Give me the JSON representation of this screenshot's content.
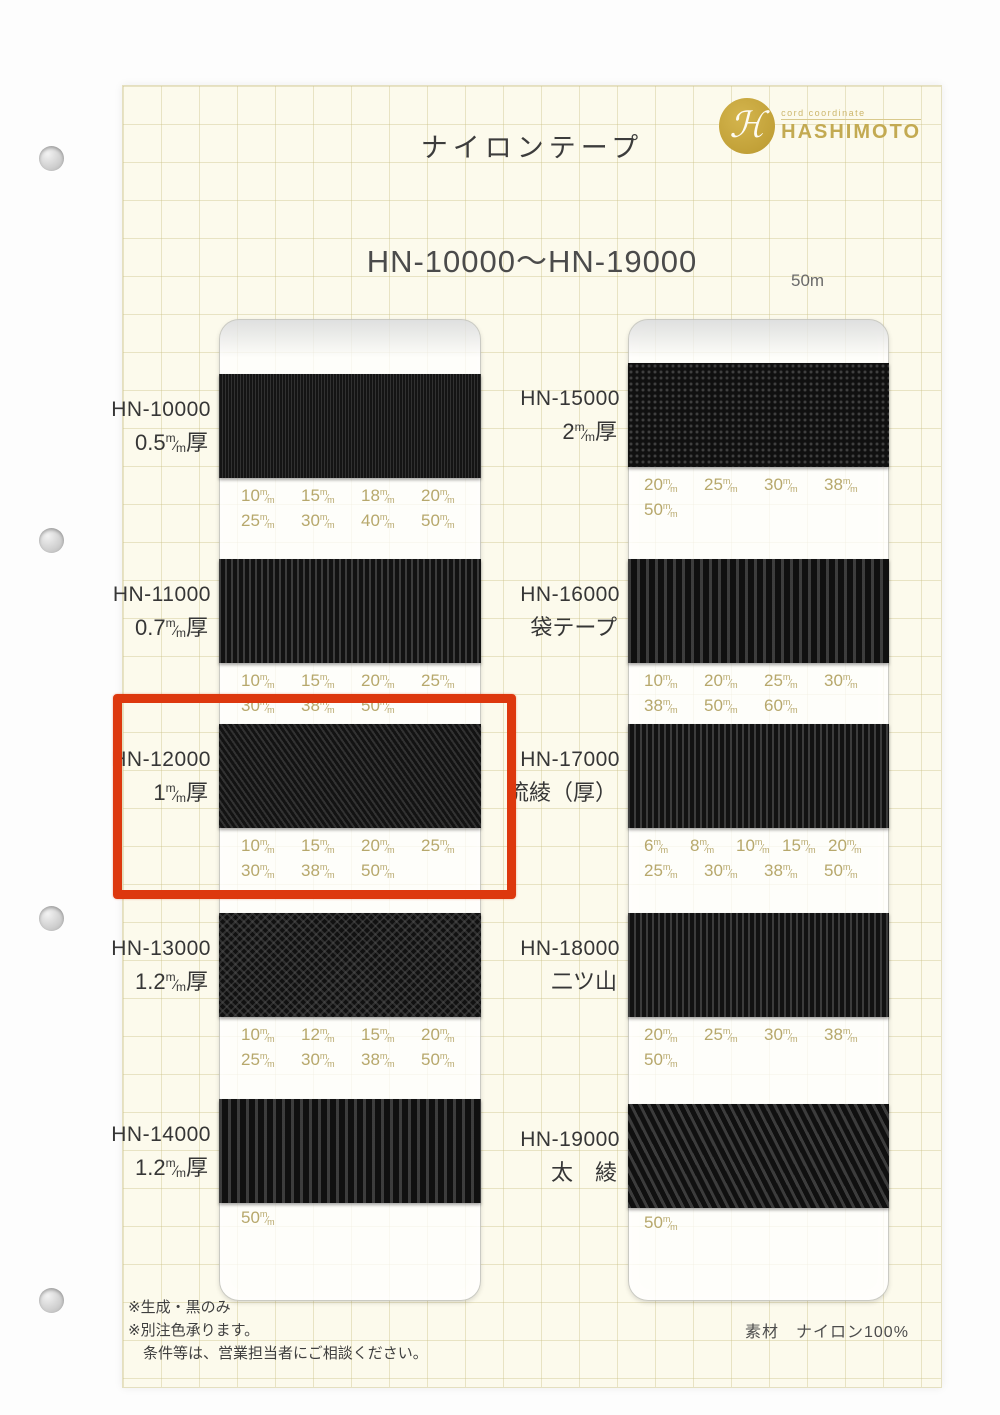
{
  "page": {
    "title": "ナイロンテープ",
    "range_heading": "HN-10000～HN-19000",
    "length_label": "50m",
    "material": "素材　ナイロン100%",
    "notes": [
      "※生成・黒のみ",
      "※別注色承ります。",
      "条件等は、営業担当者にご相談ください。"
    ],
    "highlight_color": "#dd380e",
    "size_text_color": "#b7a86c"
  },
  "logo": {
    "tagline": "cord coordinate",
    "name": "HASHIMOTO",
    "gold": "#c2a138"
  },
  "unit": {
    "sup": "m",
    "sub": "m"
  },
  "columns": [
    {
      "samples": [
        {
          "code": "HN-10000",
          "spec": {
            "kind": "mm",
            "value": "0.5",
            "suffix": "厚"
          },
          "sizes_row1": [
            "10",
            "15",
            "18",
            "20"
          ],
          "sizes_row2": [
            "25",
            "30",
            "40",
            "50"
          ],
          "texture": "fine"
        },
        {
          "code": "HN-11000",
          "spec": {
            "kind": "mm",
            "value": "0.7",
            "suffix": "厚"
          },
          "sizes_row1": [
            "10",
            "15",
            "20",
            "25"
          ],
          "sizes_row2": [
            "30",
            "38",
            "50"
          ],
          "texture": "rib"
        },
        {
          "code": "HN-12000",
          "spec": {
            "kind": "mm",
            "value": "1",
            "suffix": "厚"
          },
          "sizes_row1": [
            "10",
            "15",
            "20",
            "25"
          ],
          "sizes_row2": [
            "30",
            "38",
            "50"
          ],
          "texture": "diag",
          "highlight": true
        },
        {
          "code": "HN-13000",
          "spec": {
            "kind": "mm",
            "value": "1.2",
            "suffix": "厚"
          },
          "sizes_row1": [
            "10",
            "12",
            "15",
            "20"
          ],
          "sizes_row2": [
            "25",
            "30",
            "38",
            "50"
          ],
          "texture": "zigzag"
        },
        {
          "code": "HN-14000",
          "spec": {
            "kind": "mm",
            "value": "1.2",
            "suffix": "厚"
          },
          "sizes_row1": [
            "20",
            "25",
            "30",
            "38"
          ],
          "sizes_row2": [
            "50"
          ],
          "texture": "ribwide",
          "overlap": true
        }
      ]
    },
    {
      "samples": [
        {
          "code": "HN-15000",
          "spec": {
            "kind": "mm",
            "value": "2",
            "suffix": "厚"
          },
          "sizes_row1": [
            "20",
            "25",
            "30",
            "38"
          ],
          "sizes_row2": [
            "50"
          ],
          "texture": "basket"
        },
        {
          "code": "HN-16000",
          "spec": {
            "kind": "text",
            "value": "袋テープ"
          },
          "sizes_row1": [
            "10",
            "20",
            "25",
            "30"
          ],
          "sizes_row2": [
            "38",
            "50",
            "60"
          ],
          "texture": "ribwide"
        },
        {
          "code": "HN-17000",
          "spec": {
            "kind": "text",
            "value": "流綾（厚）"
          },
          "sizes_row1": [
            "6",
            "8",
            "10",
            "15",
            "20"
          ],
          "sizes_row2": [
            "25",
            "30",
            "38",
            "50"
          ],
          "texture": "rib"
        },
        {
          "code": "HN-18000",
          "spec": {
            "kind": "text",
            "value": "二ツ山"
          },
          "sizes_row1": [
            "20",
            "25",
            "30",
            "38"
          ],
          "sizes_row2": [
            "50"
          ],
          "texture": "rib"
        },
        {
          "code": "HN-19000",
          "spec": {
            "kind": "text",
            "value": "太　綾"
          },
          "sizes_row1": [
            "20",
            "25",
            "30",
            "38"
          ],
          "sizes_row2": [
            "50"
          ],
          "texture": "twill",
          "overlap": true
        }
      ]
    }
  ]
}
